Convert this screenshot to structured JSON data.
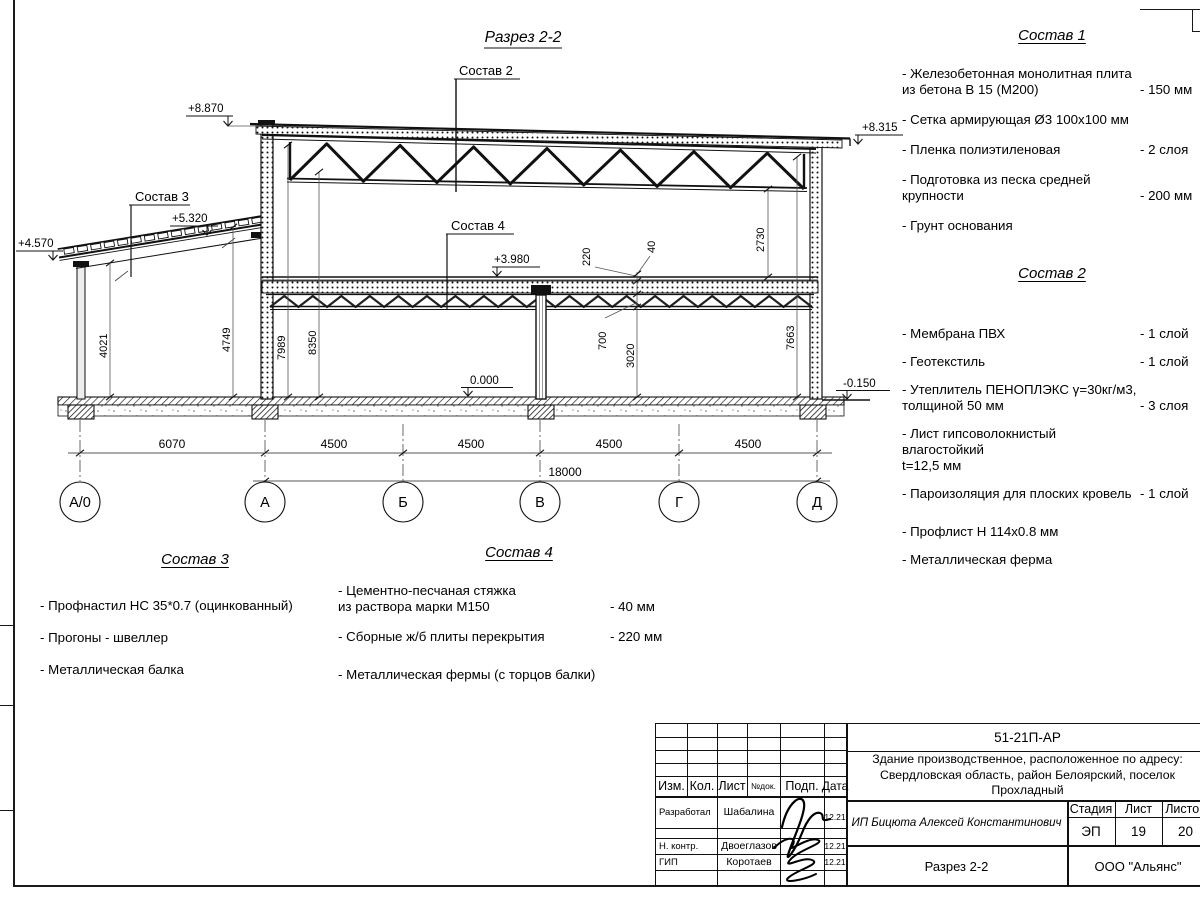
{
  "drawing": {
    "title": "Разрез 2-2",
    "callouts": {
      "roof": "Состав 2",
      "annex": "Состав 3",
      "floor": "Состав 4"
    },
    "elev": {
      "roof_left": "+8.870",
      "roof_right": "+8.315",
      "annex_left": "+4.570",
      "annex_right": "+5.320",
      "floor2": "+3.980",
      "zero": "0.000",
      "ground": "-0.150"
    },
    "vdims": {
      "annex_left": "4021",
      "annex_right": "4749",
      "wall_a_1": "7989",
      "wall_a_2": "8350",
      "truss_clear": "2730",
      "slab": "220",
      "screed": "40",
      "floor_truss": "700",
      "floor_clear": "3020",
      "wall_d": "7663"
    },
    "hdims": {
      "s1": "6070",
      "s2": "4500",
      "s3": "4500",
      "s4": "4500",
      "s5": "4500",
      "total": "18000"
    },
    "axes": {
      "a0": "А/0",
      "a": "А",
      "b": "Б",
      "v": "В",
      "g": "Г",
      "d": "Д"
    }
  },
  "sostav1": {
    "title": "Состав 1",
    "items": [
      {
        "name": "- Железобетонная  монолитная плита\nиз бетона В 15 (М200)",
        "value": "- 150 мм"
      },
      {
        "name": "- Сетка армирующая Ø3 100х100 мм",
        "value": ""
      },
      {
        "name": "- Пленка полиэтиленовая",
        "value": "- 2 слоя"
      },
      {
        "name": "- Подготовка из песка средней\nкрупности",
        "value": "- 200 мм"
      },
      {
        "name": "- Грунт основания",
        "value": ""
      }
    ]
  },
  "sostav2": {
    "title": "Состав 2",
    "items": [
      {
        "name": "- Мембрана ПВХ",
        "value": "- 1 слой"
      },
      {
        "name": "- Геотекстиль",
        "value": "- 1 слой"
      },
      {
        "name": "- Утеплитель ПЕНОПЛЭКС γ=30кг/м3,\nтолщиной 50 мм",
        "value": "- 3 слоя"
      },
      {
        "name": "- Лист гипсоволокнистый влагостойкий\nt=12,5 мм",
        "value": ""
      },
      {
        "name": "- Пароизоляция для плоских кровель",
        "value": "- 1 слой"
      },
      {
        "name": "- Профлист Н 114х0.8 мм",
        "value": ""
      },
      {
        "name": "- Металлическая ферма",
        "value": ""
      }
    ]
  },
  "sostav3": {
    "title": "Состав 3",
    "items": [
      {
        "name": "- Профнастил НС 35*0.7 (оцинкованный)",
        "value": ""
      },
      {
        "name": "- Прогоны - швеллер",
        "value": ""
      },
      {
        "name": "- Металлическая балка",
        "value": ""
      }
    ]
  },
  "sostav4": {
    "title": "Состав 4",
    "items": [
      {
        "name": "- Цементно-песчаная стяжка\nиз раствора марки М150",
        "value": "- 40 мм"
      },
      {
        "name": "- Сборные ж/б плиты перекрытия",
        "value": "- 220 мм"
      },
      {
        "name": "- Металлическая фермы (с торцов балки)",
        "value": ""
      }
    ]
  },
  "titleblock": {
    "code": "51-21П-АР",
    "address": "Здание производственное, расположенное по адресу:\nСвердловская область, район Белоярский, поселок\nПрохладный",
    "cols": {
      "izm": "Изм.",
      "kol": "Кол.",
      "list": "Лист",
      "ndok": "№док.",
      "podp": "Подп.",
      "data": "Дата"
    },
    "rows": [
      {
        "role": "Разработал",
        "name": "Шабалина",
        "date": "12.21"
      },
      {
        "role": "Н. контр.",
        "name": "Двоеглазов",
        "date": "12.21"
      },
      {
        "role": "ГИП",
        "name": "Коротаев",
        "date": "12.21"
      }
    ],
    "customer": "ИП Бицюта Алексей Константинович",
    "stage_label": "Стадия",
    "sheet_label": "Лист",
    "sheets_label": "Листов",
    "stage": "ЭП",
    "sheet": "19",
    "sheets": "20",
    "doc_title": "Разрез 2-2",
    "company": "ООО \"Альянс\""
  }
}
